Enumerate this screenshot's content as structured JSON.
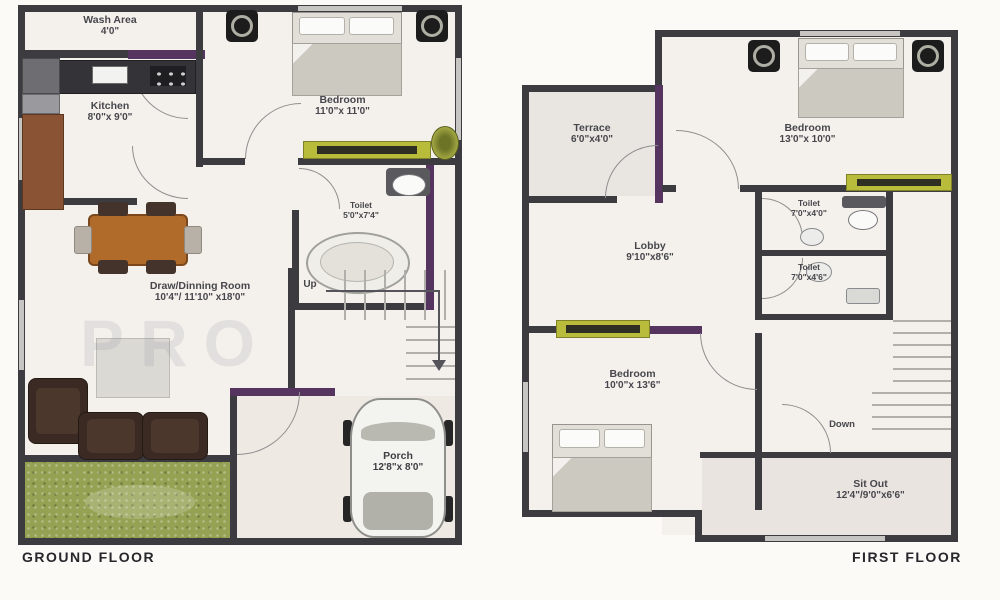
{
  "ground": {
    "title": "GROUND FLOOR",
    "watermark": "PRO",
    "stairs_label": "Up",
    "rooms": {
      "wash_area": {
        "name": "Wash Area",
        "dim": "4'0\""
      },
      "kitchen": {
        "name": "Kitchen",
        "dim": "8'0\"x 9'0\""
      },
      "bedroom": {
        "name": "Bedroom",
        "dim": "11'0\"x 11'0\""
      },
      "toilet": {
        "name": "Toilet",
        "dim": "5'0\"x7'4\""
      },
      "drawing_dining": {
        "name": "Draw/Dinning Room",
        "dim": "10'4\"/ 11'10\" x18'0\""
      },
      "porch": {
        "name": "Porch",
        "dim": "12'8\"x 8'0\""
      }
    }
  },
  "first": {
    "title": "FIRST FLOOR",
    "stairs_label": "Down",
    "rooms": {
      "terrace": {
        "name": "Terrace",
        "dim": "6'0\"x4'0\""
      },
      "bedroom_master": {
        "name": "Bedroom",
        "dim": "13'0\"x 10'0\""
      },
      "toilet_top": {
        "name": "Toilet",
        "dim": "7'0\"x4'0\""
      },
      "toilet_bottom": {
        "name": "Toilet",
        "dim": "7'0\"x4'6\""
      },
      "lobby": {
        "name": "Lobby",
        "dim": "9'10\"x8'6\""
      },
      "bedroom_second": {
        "name": "Bedroom",
        "dim": "10'0\"x 13'6\""
      },
      "sit_out": {
        "name": "Sit Out",
        "dim": "12'4\"/9'0\"x6'6\""
      }
    }
  },
  "colors": {
    "wall": "#3c3b40",
    "accent_wall_purple": "#55355f",
    "window_console_olive": "#b9bc3a",
    "lawn_green": "#95a254",
    "dining_table_wood": "#b06a2a",
    "sofa_brown": "#3a2a23",
    "floor": "#f4f1ec"
  },
  "icons": {
    "ceiling_fan": "square-with-ring",
    "car_top_view": "rounded-body-4-wheels",
    "stairs": "parallel-tread-lines",
    "door": "quarter-circle-arc"
  }
}
